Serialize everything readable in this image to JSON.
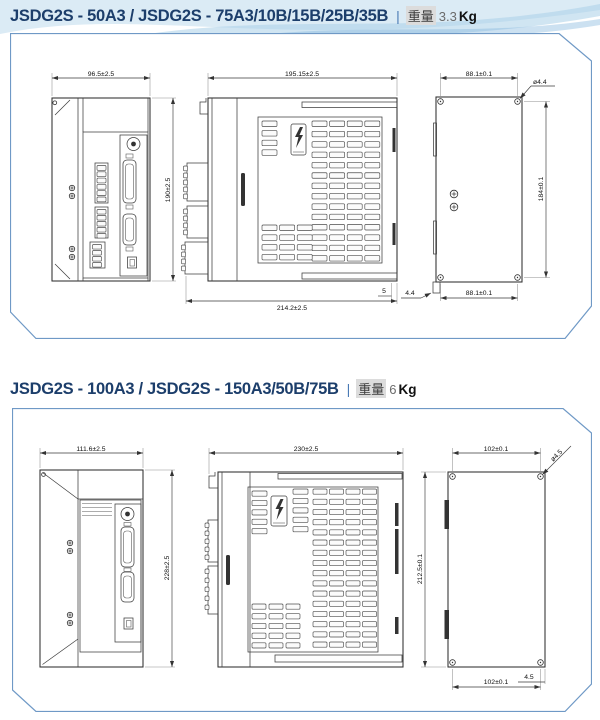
{
  "colors": {
    "title": "#1c3e6b",
    "panel_border": "#6f99c6",
    "swoosh": "#a9cfe8"
  },
  "sections": [
    {
      "title": {
        "model": "JSDG2S - 50A3 / JSDG2S - 75A3/10B/15B/25B/35B",
        "divider": "|",
        "weight_label": "重量",
        "weight_value": "3.3",
        "weight_unit": "Kg"
      },
      "front": {
        "width_dim": "96.5±2.5",
        "height_dim": "190±2.5"
      },
      "side": {
        "width_top_dim": "195.15±2.5",
        "width_bottom_dim": "214.2±2.5",
        "flange_dim": "5"
      },
      "back": {
        "width_top_dim": "88.1±0.1",
        "width_bottom_dim": "88.1±0.1",
        "height_dim": "184±0.1",
        "hole_dim": "ø4.4",
        "tab_dim": "4.4"
      }
    },
    {
      "title": {
        "model": "JSDG2S - 100A3 / JSDG2S - 150A3/50B/75B",
        "divider": "|",
        "weight_label": "重量",
        "weight_value": "6",
        "weight_unit": "Kg"
      },
      "front": {
        "width_dim": "111.6±2.5",
        "height_dim": "228±2.5"
      },
      "side": {
        "width_top_dim": "230±2.5"
      },
      "back": {
        "width_top_dim": "102±0.1",
        "width_bottom_dim": "102±0.1",
        "height_dim": "212.5±0.1",
        "hole_dim": "ø4.5",
        "tab_dim": "4.5"
      }
    }
  ]
}
